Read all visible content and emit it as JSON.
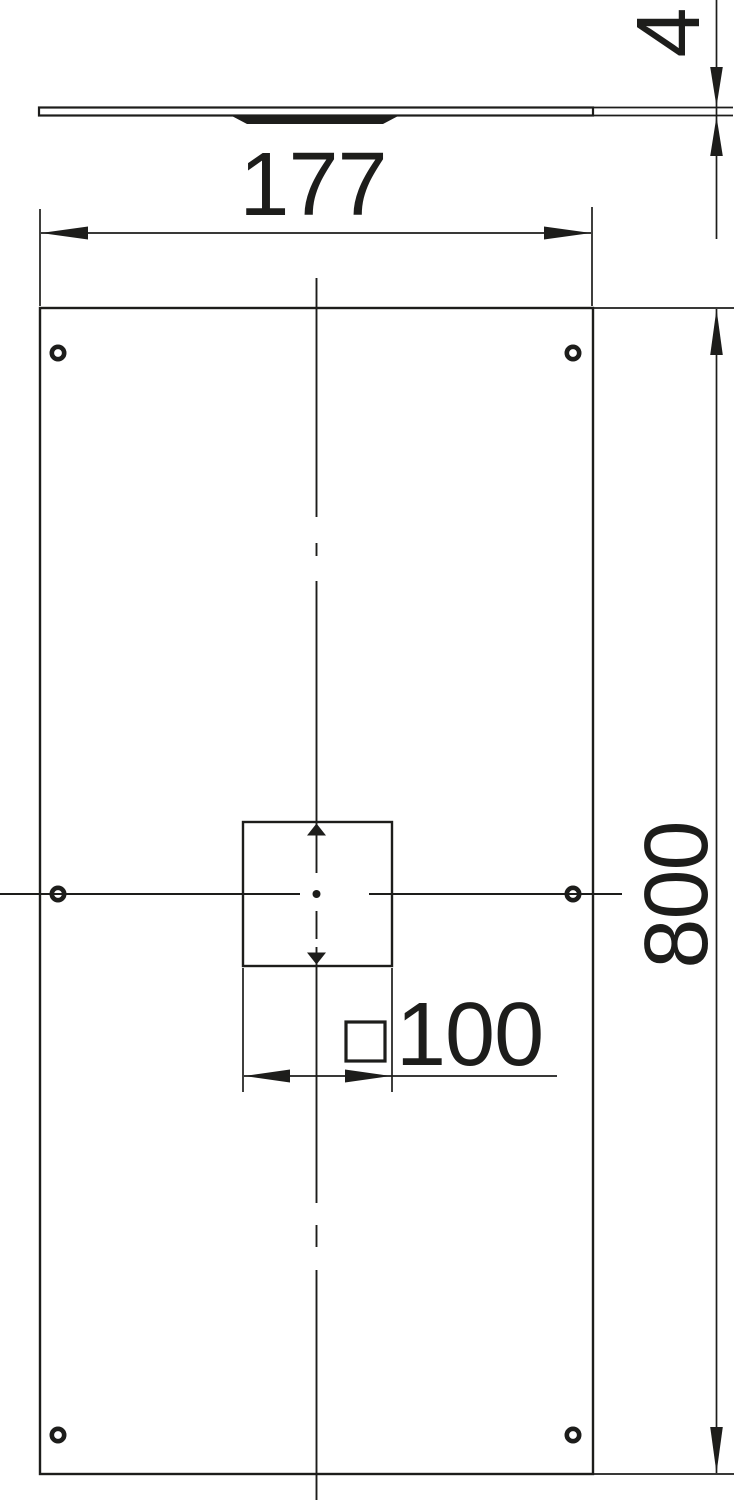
{
  "drawing": {
    "background_color": "#ffffff",
    "line_color": "#1d1d1b",
    "dimensions": {
      "thickness": {
        "value": "4",
        "orientation": "vertical-rotated"
      },
      "width": {
        "value": "177",
        "orientation": "horizontal"
      },
      "height": {
        "value": "800",
        "orientation": "vertical-rotated"
      },
      "cutout_size": {
        "value": "100",
        "symbol": "□",
        "symbol_name": "square-symbol"
      }
    },
    "front_view": {
      "hole_count": 6,
      "cutout_shape": "square"
    }
  }
}
